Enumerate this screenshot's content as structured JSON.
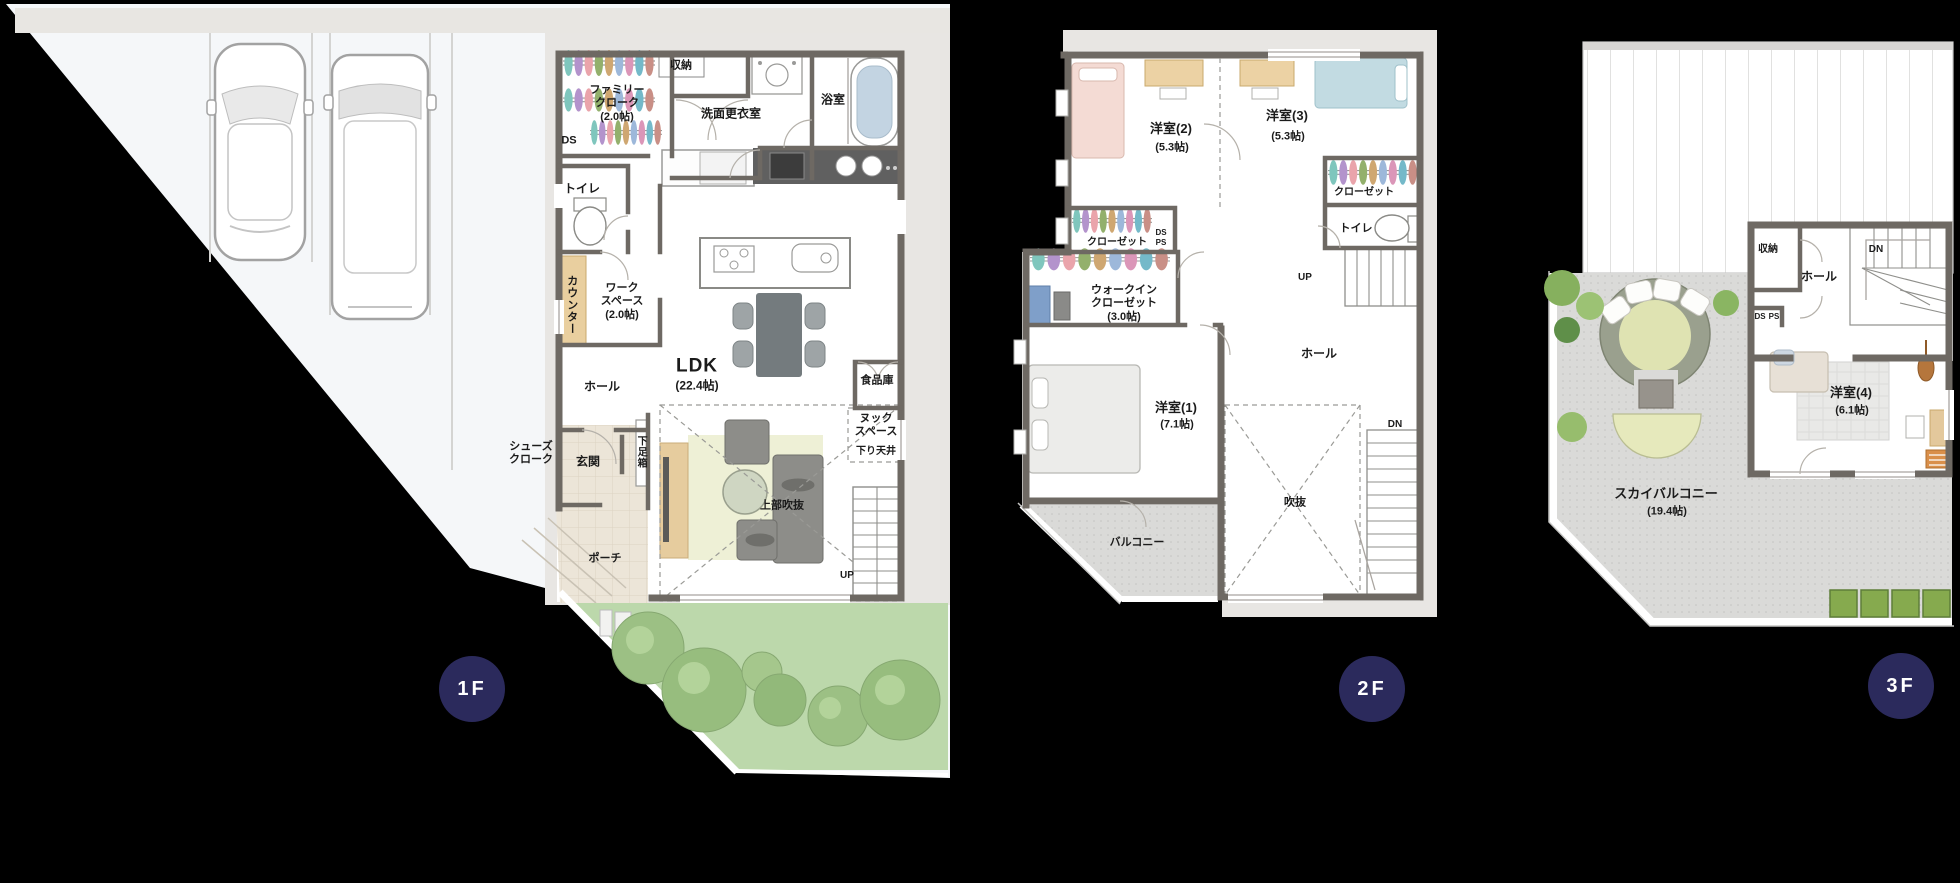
{
  "floors": {
    "f1": {
      "badge": "1F",
      "labels": {
        "family_cloak": "ファミリー\nクローク\n(2.0帖)",
        "ds": "DS",
        "storage": "収納",
        "washroom": "洗面更衣室",
        "bathroom": "浴室",
        "toilet": "トイレ",
        "counter": "カウンター",
        "workspace": "ワーク\nスペース\n(2.0帖)",
        "ldk": "LDK",
        "ldk_size": "(22.4帖)",
        "hall": "ホール",
        "pantry": "食品庫",
        "nook": "ヌック\nスペース",
        "lowered_ceiling": "下り天井",
        "shoes_cloak": "シューズ\nクローク",
        "entrance": "玄関",
        "shoe_box": "下足箱",
        "porch": "ポーチ",
        "upper_void": "上部吹抜",
        "up": "UP"
      }
    },
    "f2": {
      "badge": "2F",
      "labels": {
        "room2": "洋室(2)",
        "room2_size": "(5.3帖)",
        "room3": "洋室(3)",
        "room3_size": "(5.3帖)",
        "closet_right": "クローゼット",
        "toilet": "トイレ",
        "closet_left": "クローゼット",
        "ds": "DS",
        "ps": "PS",
        "wic": "ウォークイン\nクローゼット\n(3.0帖)",
        "room1": "洋室(1)",
        "room1_size": "(7.1帖)",
        "hall": "ホール",
        "balcony": "バルコニー",
        "void": "吹抜",
        "up": "UP",
        "dn": "DN"
      }
    },
    "f3": {
      "badge": "3F",
      "labels": {
        "storage": "収納",
        "hall": "ホール",
        "dn": "DN",
        "ds": "DS",
        "ps": "PS",
        "room4": "洋室(4)",
        "room4_size": "(6.1帖)",
        "sky_balcony": "スカイバルコニー",
        "sky_balcony_size": "(19.4帖)"
      }
    }
  },
  "colors": {
    "background": "#000000",
    "badge": "#2b2a5c",
    "wall": "#6e6963",
    "mat": "#e8e6e3",
    "lawn": "#bcd8ab",
    "tree": "#9cc084",
    "balcony": "#dadad8",
    "bath_water": "#c3d4e2",
    "wood_counter": "#e9cf9f",
    "bed_pink": "#f4dbd4",
    "bed_blue": "#c2dbe2"
  }
}
